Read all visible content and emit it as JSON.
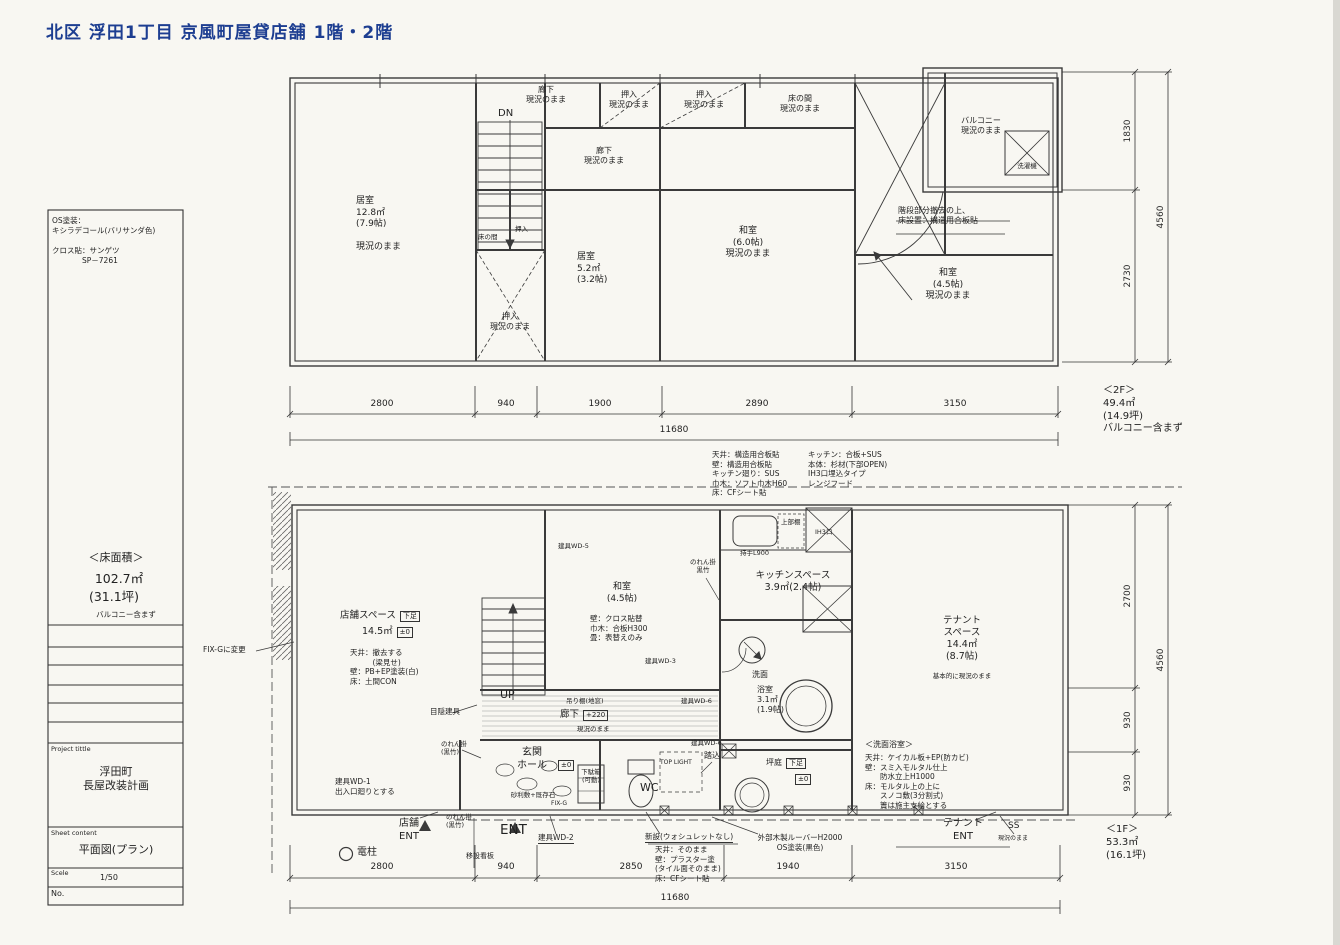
{
  "title": "北区 浮田1丁目 京風町屋貸店舗 1階・2階",
  "colors": {
    "title_blue": "#1d3e91",
    "paper": "#f8f7f2",
    "line": "#3a3a3a"
  },
  "sidebar": {
    "finish_note_1": "OS塗装：\nキシラデコール(バリサンダ色)",
    "finish_note_2": "クロス貼：サンゲツ\n　　　　SP－7261",
    "floor_area_title": "＜床面積＞",
    "floor_area_value": "102.7㎡",
    "floor_area_tsubo": "(31.1坪)",
    "floor_area_note": "バルコニー含まず",
    "project_label": "Project tittle",
    "project_name": "浮田町\n長屋改装計画",
    "sheet_label": "Sheet content",
    "sheet_name": "平面図(プラン)",
    "scale_label": "Scele",
    "scale_value": "1/50",
    "no_label": "No."
  },
  "floor2": {
    "hall_top": "廊下\n現況のまま",
    "dn": "DN",
    "closet_top_1": "押入\n現況のまま",
    "closet_top_2": "押入\n現況のまま",
    "tokonoma_top": "床の間\n現況のまま",
    "balcony": "バルコニー\n現況のまま",
    "washer": "洗濯機",
    "hall_right": "廊下\n現況のまま",
    "living_room": "居室\n12.8㎡\n(7.9帖)\n\n現況のまま",
    "tokonoma_small": "床の間",
    "closet_small": "押入",
    "room_5_2": "居室\n5.2㎡\n(3.2帖)",
    "closet_lower": "押入\n現況のまま",
    "washitsu_6": "和室\n(6.0帖)\n現況のまま",
    "stair_removal_note": "階段部分撤去の上、\n床設置：構造用合板貼",
    "washitsu_45": "和室\n(4.5帖)\n現況のまま",
    "dims_bottom": [
      "2800",
      "940",
      "1900",
      "2890",
      "3150"
    ],
    "dims_total": "11680",
    "dims_right": [
      "1830",
      "2730"
    ],
    "dims_right_total": "4560",
    "summary": "＜2F＞\n49.4㎡\n(14.9坪)\nバルコニー含まず"
  },
  "mid_notes": {
    "col1": "天井：構造用合板貼\n壁：構造用合板貼\nキッチン廻り：SUS\n巾木：ソフト巾木H60\n床：CFシート貼",
    "col2": "キッチン：合板+SUS\n本体：杉材(下部OPEN)\nIH3口埋込タイプ\nレンジフード"
  },
  "floor1": {
    "fix_g": "FIX-Gに変更",
    "shop_title": "店舗スペース",
    "shop_tag": "下足",
    "shop_area": "14.5㎡",
    "shop_level": "±0",
    "shop_spec": "天井：撤去する\n　　　(梁見せ)\n壁：PB+EP塗装(白)\n床：土間CON",
    "wd5": "建具WD-5",
    "washitsu": "和室\n(4.5帖)",
    "washitsu_spec": "壁：クロス貼替\n巾木：合板H300\n畳：表替えのみ",
    "noren_kitchen": "のれん掛\n黒竹",
    "handle": "持手L900",
    "upper_shelf": "上部棚",
    "ih": "IH3口",
    "kitchen": "キッチンスペース\n3.9㎡(2.4帖)",
    "tenant": "テナント\nスペース\n14.4㎡\n(8.7帖)",
    "tenant_note": "基本的に現況のまま",
    "senmen": "洗面",
    "bath": "浴室\n3.1㎡\n(1.9帖)",
    "up": "UP",
    "hanging_shelf": "吊り棚(地窓)",
    "hall_label": "廊下",
    "hall_level": "+220",
    "hall_note": "現況のまま",
    "mekakushi": "目隠建具",
    "wd3": "建具WD-3",
    "wd6_a": "建具WD-6",
    "wd6_b": "建具WD-6",
    "noren_left": "のれん掛\n(黒竹)",
    "wd1": "建具WD-1\n出入口廻りとする",
    "genkan": "玄関\nホール",
    "genkan_level": "±0",
    "genkan_floor": "砂利敷+既存石",
    "fix_g_small": "FIX-G",
    "getabako": "下駄箱\n(可動)",
    "wc": "WC",
    "top_light": "TOP LIGHT",
    "fumikomi": "踏込",
    "tsuboniwa": "坪庭",
    "tsuboniwa_tag": "下足",
    "tsuboniwa_level": "±0",
    "bath_note_title": "＜洗面浴室＞",
    "bath_note": "天井：ケイカル板+EP(防カビ)\n壁：スミ入モルタル仕上\n　　防水立上H1000\n床：モルタル上の上に\n　　スノコ敷(3分割式)\n　　簀は施主支給とする",
    "noren_bottom": "のれん掛\n(黒竹)",
    "shop_ent": "店舗\nENT",
    "denchu": "電柱",
    "ent": "ENT",
    "sign": "移設看板",
    "wd2": "建具WD-2",
    "toilet_note_title": "新設(ウォシュレットなし)",
    "toilet_note": "天井：そのまま\n壁：プラスター塗\n(タイル面そのまま)\n床：CFシート貼",
    "louver_note": "外部木製ルーバーH2000\nOS塗装(黒色)",
    "tenant_ent": "テナント\nENT",
    "ss": "SS",
    "ss_note": "現況のまま",
    "dims_bottom": [
      "2800",
      "940",
      "2850",
      "1940",
      "3150"
    ],
    "dims_total": "11680",
    "dims_right": [
      "2700",
      "930",
      "930"
    ],
    "dims_right_total": "4560",
    "summary": "＜1F＞\n53.3㎡\n(16.1坪)"
  }
}
